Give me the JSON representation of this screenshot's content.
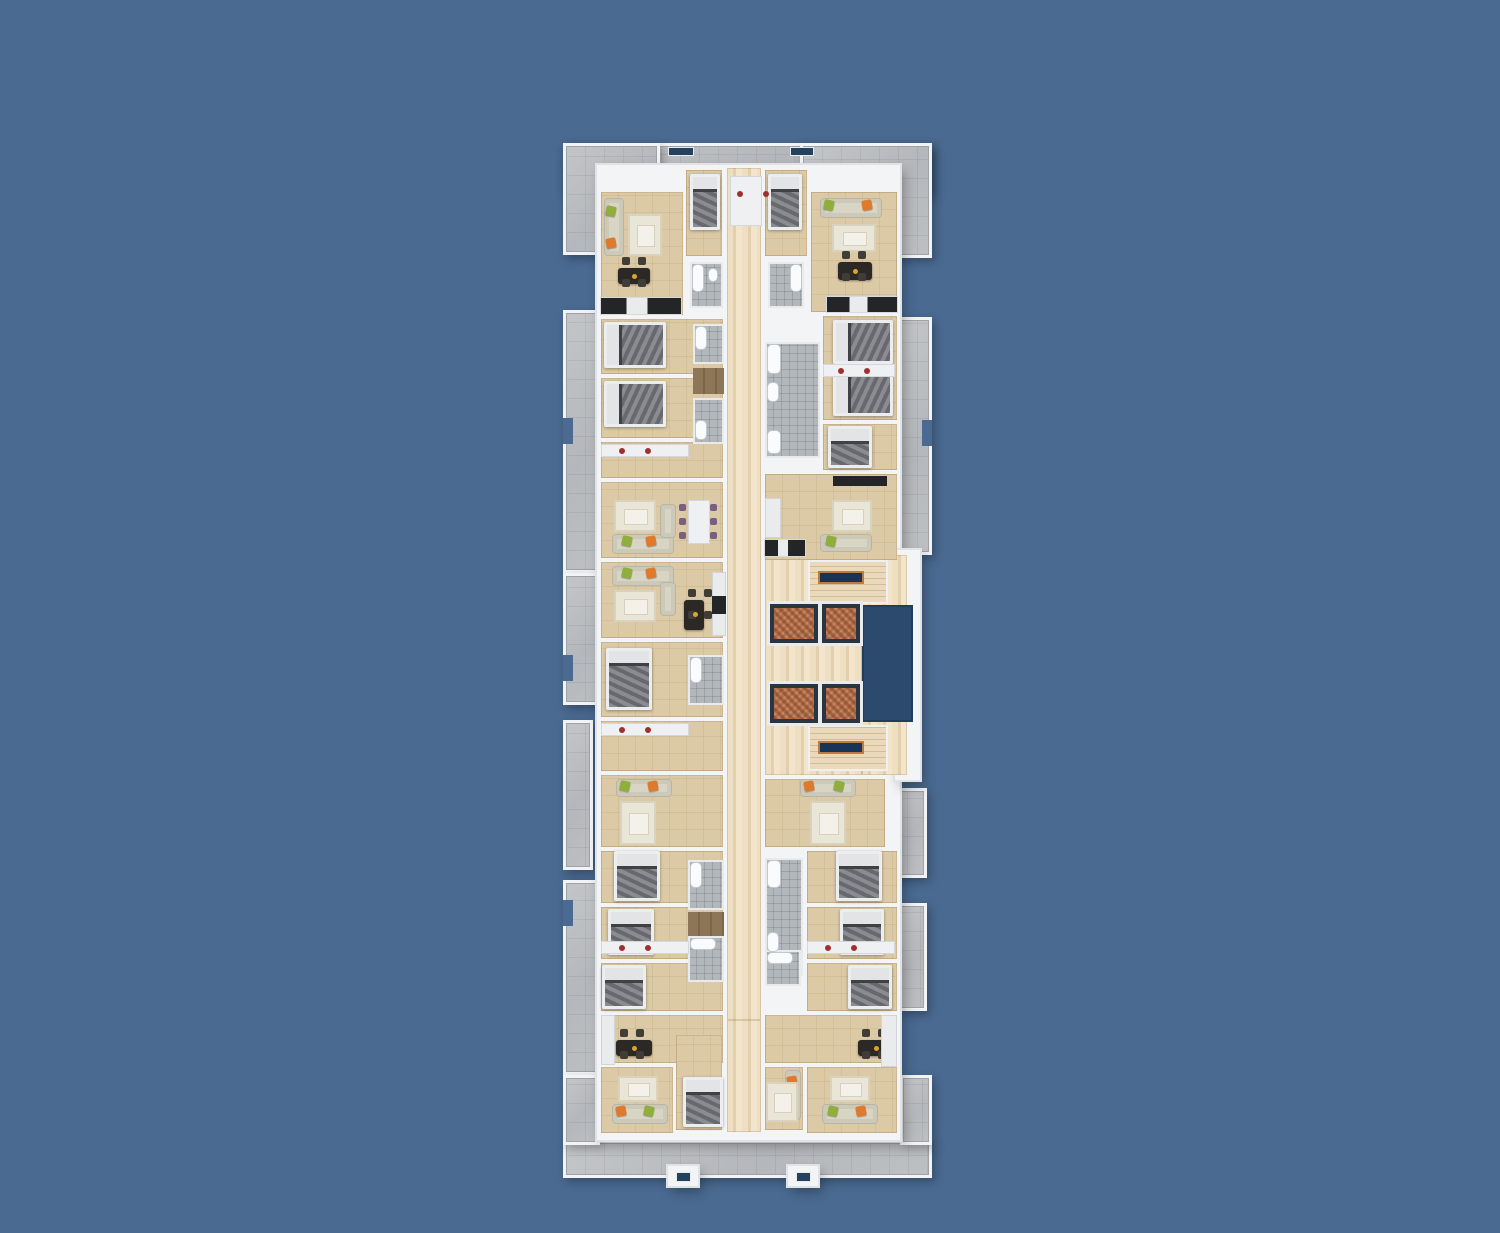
{
  "meta": {
    "description": "Top-down 3D architectural floor plan render of one apartment-building storey on a plain blue backdrop; no text labels are visible in the image.",
    "canvas": {
      "w": 1500,
      "h": 1233
    }
  },
  "palette": {
    "background_blue": "#4a6a91",
    "balcony_gray": "#bcbfc3",
    "wall_white": "#f3f4f6",
    "floor_beige": "#dccaa6",
    "corridor_travertine": "#eedec2",
    "hall_wood": "#8d7557",
    "bath_tile_gray": "#b2b7bc",
    "fixture_white": "#fafbfc",
    "shaft_navy": "#2c4a6e",
    "stair_landing_navy": "#173459",
    "stair_landing_trim": "#bd7a45",
    "elevator_copper": "#b5704c",
    "elevator_frame": "#2a3542",
    "bed_mattress_gray": "#77797e",
    "bed_frame_white": "#ecedef",
    "sofa_cream": "#d9d5c5",
    "pillow_green": "#8fae3c",
    "pillow_orange": "#df7a2c",
    "rug_cream": "#eae6d7",
    "table_dark": "#2b2826",
    "table_white": "#eef0f1",
    "chair_purple": "#7a5f80",
    "kitchen_appliance_dark": "#232527",
    "counter_white": "#e9ebed",
    "desk_chair_red": "#a03030"
  },
  "item_format": [
    "name",
    "x",
    "y",
    "w",
    "h",
    "class"
  ],
  "scene": {
    "items": [
      [
        "balcony-top-band",
        563,
        143,
        369,
        53,
        "bal"
      ],
      [
        "balcony-top-left",
        563,
        143,
        97,
        112,
        "bal"
      ],
      [
        "balcony-top-right",
        800,
        143,
        132,
        115,
        "bal"
      ],
      [
        "balcony-left-upper",
        563,
        310,
        38,
        263,
        "bal"
      ],
      [
        "balcony-left-mid",
        563,
        573,
        50,
        132,
        "bal"
      ],
      [
        "balcony-left-lower",
        563,
        720,
        30,
        150,
        "bal"
      ],
      [
        "balcony-left-bottom",
        563,
        880,
        38,
        195,
        "bal"
      ],
      [
        "balcony-right-upper",
        895,
        317,
        37,
        238,
        "bal"
      ],
      [
        "balcony-right-mid",
        885,
        788,
        42,
        90,
        "bal"
      ],
      [
        "balcony-right-lower",
        898,
        903,
        29,
        108,
        "bal"
      ],
      [
        "balcony-bottom-band",
        563,
        1140,
        369,
        38,
        "bal"
      ],
      [
        "balcony-bottom-left",
        563,
        1075,
        37,
        70,
        "bal"
      ],
      [
        "balcony-bottom-right",
        900,
        1075,
        32,
        70,
        "bal"
      ],
      [
        "parapet-gap-left-1",
        563,
        418,
        10,
        26,
        "cut"
      ],
      [
        "parapet-gap-left-2",
        563,
        655,
        10,
        26,
        "cut"
      ],
      [
        "parapet-gap-left-3",
        563,
        900,
        10,
        26,
        "cut"
      ],
      [
        "parapet-gap-right-1",
        922,
        420,
        10,
        26,
        "cut"
      ],
      [
        "building-slab",
        597,
        165,
        303,
        975,
        "base"
      ],
      [
        "core-slab",
        895,
        550,
        25,
        230,
        "base"
      ],
      [
        "entrance-stoop-left",
        668,
        1166,
        30,
        20,
        "base"
      ],
      [
        "entrance-stoop-right",
        788,
        1166,
        30,
        20,
        "base"
      ],
      [
        "corridor-main",
        727,
        168,
        34,
        852,
        "cor"
      ],
      [
        "corridor-south",
        727,
        1020,
        34,
        112,
        "cor"
      ],
      [
        "core-lobby",
        765,
        555,
        97,
        220,
        "cor"
      ],
      [
        "core-landing-north",
        862,
        555,
        45,
        52,
        "cor"
      ],
      [
        "core-landing-south",
        862,
        720,
        45,
        55,
        "cor"
      ],
      [
        "living-top-left",
        601,
        192,
        82,
        123,
        "room"
      ],
      [
        "bedroom-top-center-left",
        686,
        170,
        36,
        86,
        "room"
      ],
      [
        "bedroom-top-center-right",
        765,
        170,
        42,
        86,
        "room"
      ],
      [
        "living-top-right",
        811,
        192,
        86,
        120,
        "room"
      ],
      [
        "bedroom-left-1",
        601,
        319,
        122,
        55,
        "room"
      ],
      [
        "bedroom-left-2",
        601,
        378,
        122,
        60,
        "room"
      ],
      [
        "hall-left-1",
        601,
        442,
        122,
        36,
        "room"
      ],
      [
        "living-left-1",
        601,
        482,
        122,
        76,
        "room"
      ],
      [
        "living-left-2",
        601,
        562,
        122,
        76,
        "room"
      ],
      [
        "bedroom-left-3",
        601,
        642,
        122,
        75,
        "room"
      ],
      [
        "hall-left-2",
        601,
        721,
        122,
        50,
        "room"
      ],
      [
        "living-lower-left",
        601,
        775,
        122,
        72,
        "room"
      ],
      [
        "bedroom-lower-left-1",
        601,
        851,
        122,
        52,
        "room"
      ],
      [
        "bedroom-lower-left-2",
        601,
        907,
        122,
        52,
        "room"
      ],
      [
        "bedroom-lower-left-3",
        601,
        963,
        122,
        48,
        "room"
      ],
      [
        "dining-bottom-left",
        601,
        1015,
        122,
        48,
        "room"
      ],
      [
        "living-bottom-left",
        601,
        1067,
        72,
        66,
        "room"
      ],
      [
        "bedroom-right-double",
        823,
        316,
        74,
        104,
        "room"
      ],
      [
        "bedroom-right-3",
        823,
        424,
        74,
        46,
        "room"
      ],
      [
        "living-right-mid",
        765,
        474,
        132,
        86,
        "room"
      ],
      [
        "living-lower-right",
        765,
        779,
        120,
        68,
        "room"
      ],
      [
        "bedroom-lower-right-1",
        807,
        851,
        90,
        52,
        "room"
      ],
      [
        "bedroom-lower-right-2",
        807,
        907,
        90,
        52,
        "room"
      ],
      [
        "bedroom-lower-right-3",
        807,
        963,
        90,
        48,
        "room"
      ],
      [
        "dining-bottom-right",
        765,
        1015,
        132,
        48,
        "room"
      ],
      [
        "living-bottom-right",
        807,
        1067,
        90,
        66,
        "room"
      ],
      [
        "bedroom-bottom-center",
        676,
        1035,
        46,
        95,
        "room"
      ],
      [
        "sitting-bottom-center",
        765,
        1067,
        38,
        63,
        "room"
      ],
      [
        "hall-wood-upper",
        693,
        368,
        31,
        26,
        "wood"
      ],
      [
        "hall-wood-lower",
        688,
        912,
        36,
        24,
        "wood"
      ],
      [
        "bath-top-center-left",
        690,
        262,
        33,
        46,
        "bath"
      ],
      [
        "bath-top-center-right",
        768,
        262,
        36,
        46,
        "bath"
      ],
      [
        "bath-mid-left-1",
        693,
        324,
        31,
        40,
        "bath"
      ],
      [
        "bath-mid-left-2",
        693,
        398,
        31,
        46,
        "bath"
      ],
      [
        "bath-right-block",
        765,
        342,
        55,
        116,
        "bath"
      ],
      [
        "bath-left-ensuite",
        688,
        655,
        36,
        50,
        "bath"
      ],
      [
        "bath-lower-left-1",
        688,
        860,
        36,
        50,
        "bath"
      ],
      [
        "bath-lower-left-2",
        688,
        936,
        36,
        46,
        "bath"
      ],
      [
        "bath-lower-right-block",
        765,
        858,
        38,
        118,
        "bath"
      ],
      [
        "bath-bottom-center-right",
        765,
        950,
        36,
        36,
        "bath"
      ],
      [
        "bathtub-1",
        692,
        264,
        12,
        28,
        "fx"
      ],
      [
        "toilet-1",
        708,
        268,
        10,
        14,
        "fx"
      ],
      [
        "bathtub-2",
        790,
        264,
        12,
        28,
        "fx"
      ],
      [
        "bathtub-3",
        695,
        326,
        12,
        24,
        "fx"
      ],
      [
        "bathtub-4",
        695,
        420,
        12,
        20,
        "fx"
      ],
      [
        "bathtub-5",
        767,
        344,
        14,
        30,
        "fx"
      ],
      [
        "toilet-2",
        767,
        382,
        12,
        20,
        "fx"
      ],
      [
        "bathtub-6",
        767,
        430,
        14,
        24,
        "fx"
      ],
      [
        "bathtub-7",
        690,
        657,
        12,
        26,
        "fx"
      ],
      [
        "bathtub-8",
        690,
        862,
        12,
        26,
        "fx"
      ],
      [
        "bathtub-9",
        767,
        860,
        14,
        28,
        "fx"
      ],
      [
        "toilet-3",
        767,
        932,
        12,
        20,
        "fx"
      ],
      [
        "vanity-1",
        767,
        952,
        26,
        12,
        "fx"
      ],
      [
        "vanity-2",
        690,
        938,
        26,
        12,
        "fx"
      ],
      [
        "elevator-shaft-void",
        862,
        605,
        51,
        117,
        "shaft"
      ],
      [
        "stair-north",
        810,
        562,
        76,
        40,
        "stairs"
      ],
      [
        "stair-north-landing",
        818,
        571,
        46,
        13,
        "lstrip"
      ],
      [
        "stair-south",
        810,
        727,
        76,
        42,
        "stairs"
      ],
      [
        "stair-south-landing",
        818,
        741,
        46,
        13,
        "lstrip"
      ],
      [
        "elevator-1",
        770,
        604,
        48,
        39,
        "elev"
      ],
      [
        "elevator-2",
        822,
        604,
        38,
        39,
        "elev"
      ],
      [
        "elevator-3",
        770,
        684,
        48,
        39,
        "elev"
      ],
      [
        "elevator-4",
        822,
        684,
        38,
        39,
        "elev"
      ],
      [
        "bed-top-center-left",
        690,
        174,
        30,
        56,
        "bed-v"
      ],
      [
        "bed-top-center-right",
        768,
        174,
        34,
        56,
        "bed-v"
      ],
      [
        "bed-left-1",
        604,
        322,
        62,
        46,
        "bed-h"
      ],
      [
        "bed-left-2",
        604,
        381,
        62,
        46,
        "bed-h"
      ],
      [
        "bed-left-3",
        606,
        648,
        46,
        62,
        "bed-v"
      ],
      [
        "bed-lower-left-1",
        614,
        851,
        46,
        50,
        "bed-v"
      ],
      [
        "bed-lower-left-2",
        608,
        909,
        46,
        46,
        "bed-v"
      ],
      [
        "bed-lower-left-3",
        602,
        965,
        44,
        44,
        "bed-v"
      ],
      [
        "bed-right-1",
        833,
        320,
        60,
        44,
        "bed-h"
      ],
      [
        "bed-right-2",
        833,
        372,
        60,
        44,
        "bed-h"
      ],
      [
        "bed-right-3",
        828,
        426,
        44,
        42,
        "bed-v"
      ],
      [
        "bed-lower-right-1",
        836,
        851,
        46,
        50,
        "bed-v"
      ],
      [
        "bed-lower-right-2",
        840,
        909,
        44,
        46,
        "bed-v"
      ],
      [
        "bed-lower-right-3",
        848,
        965,
        44,
        44,
        "bed-v"
      ],
      [
        "bed-bottom-center",
        683,
        1077,
        40,
        50,
        "bed-v"
      ],
      [
        "sofa-top-left",
        604,
        198,
        20,
        58,
        "sofa"
      ],
      [
        "pillow-green-1",
        606,
        206,
        10,
        10,
        "chip-g"
      ],
      [
        "pillow-orange-1",
        606,
        238,
        10,
        10,
        "chip-o"
      ],
      [
        "rug-top-left",
        628,
        214,
        34,
        42,
        "rug"
      ],
      [
        "sofa-top-right",
        820,
        198,
        62,
        20,
        "sofa"
      ],
      [
        "pillow-green-2",
        824,
        200,
        10,
        10,
        "chip-g"
      ],
      [
        "pillow-orange-2",
        862,
        200,
        10,
        10,
        "chip-o"
      ],
      [
        "rug-top-right",
        832,
        224,
        44,
        28,
        "rug"
      ],
      [
        "sofa-left-1",
        612,
        534,
        62,
        20,
        "sofa"
      ],
      [
        "sofa-left-1b",
        660,
        504,
        16,
        34,
        "sofa"
      ],
      [
        "pillow-green-3",
        622,
        536,
        10,
        10,
        "chip-g"
      ],
      [
        "pillow-orange-3",
        646,
        536,
        10,
        10,
        "chip-o"
      ],
      [
        "rug-left-1",
        614,
        500,
        42,
        32,
        "rug"
      ],
      [
        "sofa-left-2",
        612,
        566,
        62,
        20,
        "sofa"
      ],
      [
        "sofa-left-2b",
        660,
        582,
        16,
        34,
        "sofa"
      ],
      [
        "pillow-green-4",
        622,
        568,
        10,
        10,
        "chip-g"
      ],
      [
        "pillow-orange-4",
        646,
        568,
        10,
        10,
        "chip-o"
      ],
      [
        "rug-left-2",
        614,
        590,
        42,
        32,
        "rug"
      ],
      [
        "sofa-lower-left",
        616,
        779,
        56,
        18,
        "sofa"
      ],
      [
        "pillow-green-5",
        620,
        781,
        10,
        10,
        "chip-g"
      ],
      [
        "pillow-orange-5",
        648,
        781,
        10,
        10,
        "chip-o"
      ],
      [
        "rug-lower-left",
        620,
        801,
        36,
        44,
        "rug"
      ],
      [
        "sofa-lower-right",
        800,
        779,
        56,
        18,
        "sofa"
      ],
      [
        "pillow-orange-6",
        804,
        781,
        10,
        10,
        "chip-o"
      ],
      [
        "pillow-green-6",
        834,
        781,
        10,
        10,
        "chip-g"
      ],
      [
        "rug-lower-right",
        810,
        801,
        36,
        44,
        "rug"
      ],
      [
        "sofa-bottom-left",
        612,
        1104,
        56,
        20,
        "sofa"
      ],
      [
        "pillow-orange-7",
        616,
        1106,
        10,
        10,
        "chip-o"
      ],
      [
        "pillow-green-7",
        644,
        1106,
        10,
        10,
        "chip-g"
      ],
      [
        "rug-bottom-left",
        618,
        1076,
        40,
        26,
        "rug"
      ],
      [
        "sofa-bottom-right",
        822,
        1104,
        56,
        20,
        "sofa"
      ],
      [
        "pillow-green-8",
        828,
        1106,
        10,
        10,
        "chip-g"
      ],
      [
        "pillow-orange-8",
        856,
        1106,
        10,
        10,
        "chip-o"
      ],
      [
        "rug-bottom-right",
        830,
        1076,
        40,
        26,
        "rug"
      ],
      [
        "sofa-bottom-center",
        785,
        1070,
        16,
        50,
        "sofa"
      ],
      [
        "pillow-orange-9",
        787,
        1076,
        10,
        10,
        "chip-o"
      ],
      [
        "rug-bottom-center",
        766,
        1082,
        32,
        40,
        "rug"
      ],
      [
        "sofa-right-mid",
        820,
        534,
        52,
        18,
        "sofa"
      ],
      [
        "pillow-green-9",
        826,
        536,
        10,
        10,
        "chip-g"
      ],
      [
        "rug-right-mid",
        832,
        500,
        40,
        32,
        "rug"
      ],
      [
        "dining-table-white",
        688,
        500,
        22,
        44,
        "tableW"
      ],
      [
        "dining-table-top-left",
        618,
        268,
        32,
        16,
        "tableD"
      ],
      [
        "dining-table-top-right",
        838,
        262,
        34,
        18,
        "tableD"
      ],
      [
        "dining-table-left-2",
        684,
        600,
        20,
        30,
        "tableD"
      ],
      [
        "dining-table-bottom-left",
        616,
        1040,
        36,
        16,
        "tableD"
      ],
      [
        "dining-table-bottom-right",
        858,
        1040,
        36,
        16,
        "tableD"
      ],
      [
        "kitchen-top-left",
        601,
        298,
        80,
        16,
        "kit"
      ],
      [
        "kitchen-top-right",
        827,
        297,
        70,
        15,
        "kit"
      ],
      [
        "kitchen-counter-left-mid",
        712,
        572,
        14,
        64,
        "counter"
      ],
      [
        "kitchen-appliance-left-mid",
        712,
        596,
        14,
        18,
        "appl"
      ],
      [
        "kitchen-right-mid",
        765,
        540,
        40,
        16,
        "kit"
      ],
      [
        "kitchen-counter-right-mid",
        765,
        498,
        16,
        40,
        "counter"
      ],
      [
        "kitchen-counter-bottom-right",
        881,
        1015,
        16,
        52,
        "counter"
      ],
      [
        "kitchen-counter-bottom-left",
        601,
        1015,
        14,
        50,
        "counter"
      ],
      [
        "dresser-left-1",
        601,
        444,
        88,
        13,
        "desk"
      ],
      [
        "dresser-left-2",
        601,
        723,
        88,
        13,
        "desk"
      ],
      [
        "dresser-lower-left",
        601,
        941,
        88,
        13,
        "desk"
      ],
      [
        "dresser-lower-right",
        807,
        941,
        88,
        13,
        "desk"
      ],
      [
        "dresser-right",
        823,
        364,
        72,
        13,
        "desk"
      ],
      [
        "tv-unit-right-mid",
        833,
        476,
        54,
        10,
        "appl"
      ],
      [
        "desk-vestibule",
        730,
        176,
        32,
        50,
        "desk"
      ],
      [
        "parapet-window-left",
        668,
        147,
        26,
        9,
        "wchip"
      ],
      [
        "parapet-window-right",
        790,
        147,
        24,
        9,
        "wchip"
      ],
      [
        "stoop-window-left",
        676,
        1172,
        15,
        10,
        "wchip"
      ],
      [
        "stoop-window-right",
        796,
        1172,
        15,
        10,
        "wchip"
      ]
    ]
  }
}
